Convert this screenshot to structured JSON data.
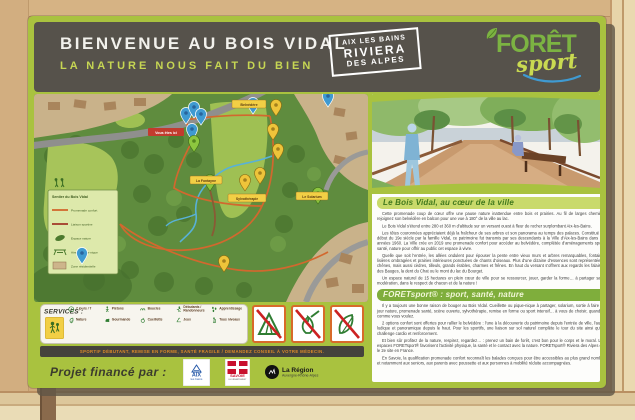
{
  "header": {
    "title": "BIENVENUE AU BOIS VIDAL",
    "subtitle": "LA NATURE NOUS FAIT DU BIEN",
    "badge": {
      "line1": "AIX LES BAINS",
      "line2": "RIVIERA",
      "line3": "DES ALPES"
    },
    "logo": {
      "part1": "FORÊT",
      "part2": "sport"
    }
  },
  "map": {
    "you_are_here": "Vous êtes ici",
    "labels": {
      "belvedere": "Belvédère",
      "fontayne": "La Fontayne",
      "sylvo": "Sylvothérapie",
      "solarium": "Le Solarium"
    },
    "legend": {
      "title": "Sentier du Bois Vidal",
      "items": [
        {
          "label": "Promenade confort",
          "color": "#d2682e"
        },
        {
          "label": "Liaison sportive",
          "color": "#a23b2a"
        },
        {
          "label": "Espace nature",
          "color": "#4c7a2e"
        },
        {
          "label": "Aire de pique-nique",
          "color": "#4c7a2e"
        },
        {
          "label": "Zone résidentielle",
          "color": "#cdb58b"
        }
      ]
    }
  },
  "services": {
    "title": "SERVICES :",
    "row1": [
      "7 jours / 7",
      "Piétons",
      "Boucles",
      "Débutants / Randonneurs",
      "Apprentissage"
    ],
    "row2": [
      "Nature",
      "Gourmande",
      "Cueillette",
      "Jeux",
      "Tous niveaux"
    ]
  },
  "warning": "SPORTIF DÉBUTANT, REMISE EN FORME, SANTÉ FRAGILE / DEMANDEZ CONSEIL À VOTRE MÉDECIN.",
  "article": {
    "section1": {
      "heading": "Le Bois Vidal, au cœur de la ville",
      "paragraphs": [
        "Cette promenade coup de cœur offre une pause nature inattendue entre bois et prairies. Au fil de larges chemins, rejoignez son belvédère en balcon pour une vue à 180° de la ville au lac.",
        "Le Bois Vidal s'étend entre 280 et 360 m d'altitude sur un versant ouest à fleur de rocher surplombant Aix-les-Bains.",
        "Les têtes couronnées appréciaient déjà la fraîcheur de ses arbres et son panorama au temps des palaces. Constitué au début du 19e siècle par la famille Vidal, ce patrimoine fut transmis par ses descendants à la Ville d'Aix-les-Bains dans les années 1960. La Ville crée en 2019 une promenade confort pour accéder au belvédère, complétée d'aménagements sport, santé, nature pour offrir au public cet espace à vivre.",
        "Quelle que soit l'entrée, les allées ondulent pour épouser la pente entre vieux murs et arbres remarquables, fontaine, lisières ombragées et prairies intérieures ponctuées de chants d'oiseaux. Plus d'une dizaine d'essences sont représentées : chênes, mais aussi cèdres, tilleuls, grands érables, charmes et frênes. En haut du versant s'offrent aux regards les falaises des Bauges, la dent du Chat ou le mont du lac du Bourget.",
        "Un espace naturel de 15 hectares en plein cœur de ville pour se ressourcer, jouer, garder la forme… à partager sans modération, dans le respect de chacun et de la nature !"
      ]
    },
    "section2": {
      "heading": "FORETsport® : sport, santé, nature",
      "paragraphs": [
        "Il y a toujours une bonne raison de bouger au Bois Vidal. Cueillette ou pique-nique à partager, solarium, sortie à faire de jour nature, promenade santé, scène ouverte, sylvothérapie, remise en forme ou sport intensif… à vous de choisir, quand et comme vous voulez.",
        "2 options confort sont offertes pour rallier le belvédère : l'une à la découverte du patrimoine depuis l'entrée de ville, l'autre ludique et panoramique depuis le haut. Pour les sportifs, une liaison sur sol naturel complète le tour du site ainsi qu'un challenge cardio et renforcement.",
        "Et bien sûr profitez de la nature, respirez, regardez… : prenez un bain de forêt, c'est bon pour le corps et le moral. Les espaces FORETsport® favorisent l'activité physique, la santé et le contact avec la nature. FORETsport® Riviera des Alpes est le 2e site en France.",
        "En Savoie, la qualification promenade confort reconnaît les balades conçues pour être accessibles au plus grand nombre et notamment aux seniors, aux parents avec poussette et aux personnes à mobilité réduite accompagnées."
      ]
    }
  },
  "footer": {
    "label": "Projet financé par :",
    "logos": {
      "aix": {
        "line1": "AIX",
        "line2": "les bains"
      },
      "savoie": {
        "name": "SAVOIE",
        "sub": "LE DÉPARTEMENT"
      },
      "region": {
        "name": "La Région",
        "sub": "Auvergne-Rhône-Alpes"
      }
    }
  },
  "colors": {
    "accent_green": "#a9c23f",
    "header_bg": "#56524b",
    "trail_orange": "#d2682e",
    "stream_blue": "#58b1d8",
    "marker_yellow": "#eec43a",
    "marker_blue": "#3f9ad1",
    "marker_green": "#8dc63f",
    "wood": "#cfa97a"
  }
}
